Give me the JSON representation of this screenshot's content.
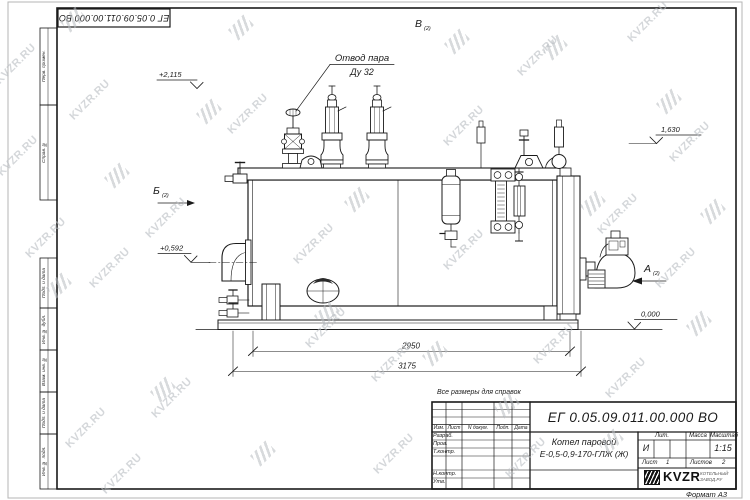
{
  "sheet": {
    "outer_stamp": "ЕГ 0.05.09.011.00.000  ВО",
    "reference_note": "Все размеры для справок",
    "format_note": "Формат А3"
  },
  "margin_labels": [
    "Перв. примен.",
    "Справ. №",
    "Подп. и дата",
    "Инв. № дубл.",
    "Взам. инв. №",
    "Подп. и дата",
    "Инв. № подл."
  ],
  "drawing": {
    "callout": {
      "line1": "Отвод пара",
      "line2": "Ду 32"
    },
    "views": {
      "a": "А",
      "b": "Б",
      "v": "В",
      "sheet_ref": "(2)"
    },
    "elevations": {
      "valve_top": "+2,115",
      "gauge_level": "1,630",
      "flue_axis": "+0,592",
      "base": "0,000"
    },
    "dimensions": {
      "skid_length": "2950",
      "overall_length": "3175"
    }
  },
  "title_block": {
    "designation": "ЕГ 0.05.09.011.00.000  ВО",
    "product_name_line1": "Котел паровой",
    "product_name_line2": "Е-0,5-0,9-170-ГЛЖ (Ж)",
    "columns": {
      "izm": "Изм.",
      "list": "Лист",
      "ndoc": "N докум.",
      "podp": "Подп.",
      "data": "Дата"
    },
    "signature_rows": [
      "Разраб.",
      "Пров.",
      "Т.контр.",
      "Н.контр.",
      "Утв."
    ],
    "lit_label": "Лит.",
    "lit_value": "И",
    "mass_label": "Масса",
    "scale_label": "Масштаб",
    "scale_value": "1:15",
    "sheet_label": "Лист",
    "sheet_number": "1",
    "sheets_label": "Листов",
    "sheets_total": "2",
    "company": {
      "name": "KVZR",
      "tagline_line1": "КОТЕЛЬНЫЙ",
      "tagline_line2": "ЗАВОД.РУ"
    }
  },
  "watermark": {
    "text": "KVZR.RU",
    "color": "#b9bdc2"
  }
}
